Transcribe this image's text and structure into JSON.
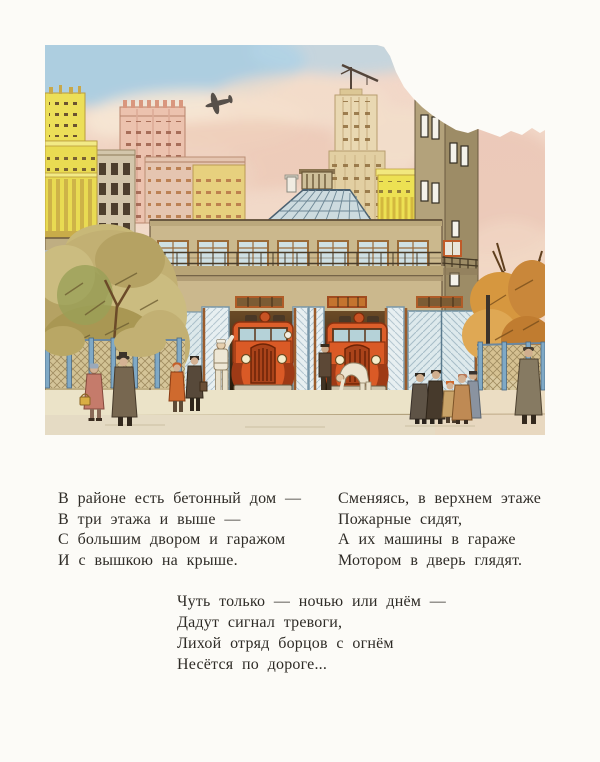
{
  "page": {
    "type": "book-page",
    "background_color": "#fcfbf7",
    "text_color": "#2e2b26"
  },
  "illustration": {
    "name": "fire-station-watercolor",
    "alt": "Watercolor illustration: a Soviet fire station with a watchtower, three garage bays and two red fire engines, firefighters in white, pedestrians on the sidewalk, autumn trees, city buildings and a small airplane in a pink-and-blue sky",
    "colors": {
      "sky_blue": "#a9cde2",
      "sky_pink": "#f2d7c9",
      "building_yellow": "#ece05e",
      "building_pink": "#ecc2ae",
      "station_tan": "#cbb88d",
      "tower_tan": "#a79674",
      "truck_red": "#dc5e2a",
      "garage_door_blue": "#dde9ec",
      "foliage_olive": "#c2b073",
      "foliage_orange": "#d0903e",
      "street_cream": "#ebe3c8"
    }
  },
  "poem": {
    "stanzas": [
      {
        "lines": [
          "В районе есть бетонный дом —",
          "В три этажа и выше —",
          "С большим двором и гаражом",
          "И с вышкою на крыше."
        ]
      },
      {
        "lines": [
          "Сменяясь, в верхнем этаже",
          "Пожарные сидят,",
          "А их машины в гараже",
          "Мотором в дверь глядят."
        ]
      },
      {
        "lines": [
          "Чуть только — ночью или днём —",
          "Дадут сигнал тревоги,",
          "Лихой отряд борцов с огнём",
          "Несётся по дороге..."
        ]
      }
    ]
  }
}
